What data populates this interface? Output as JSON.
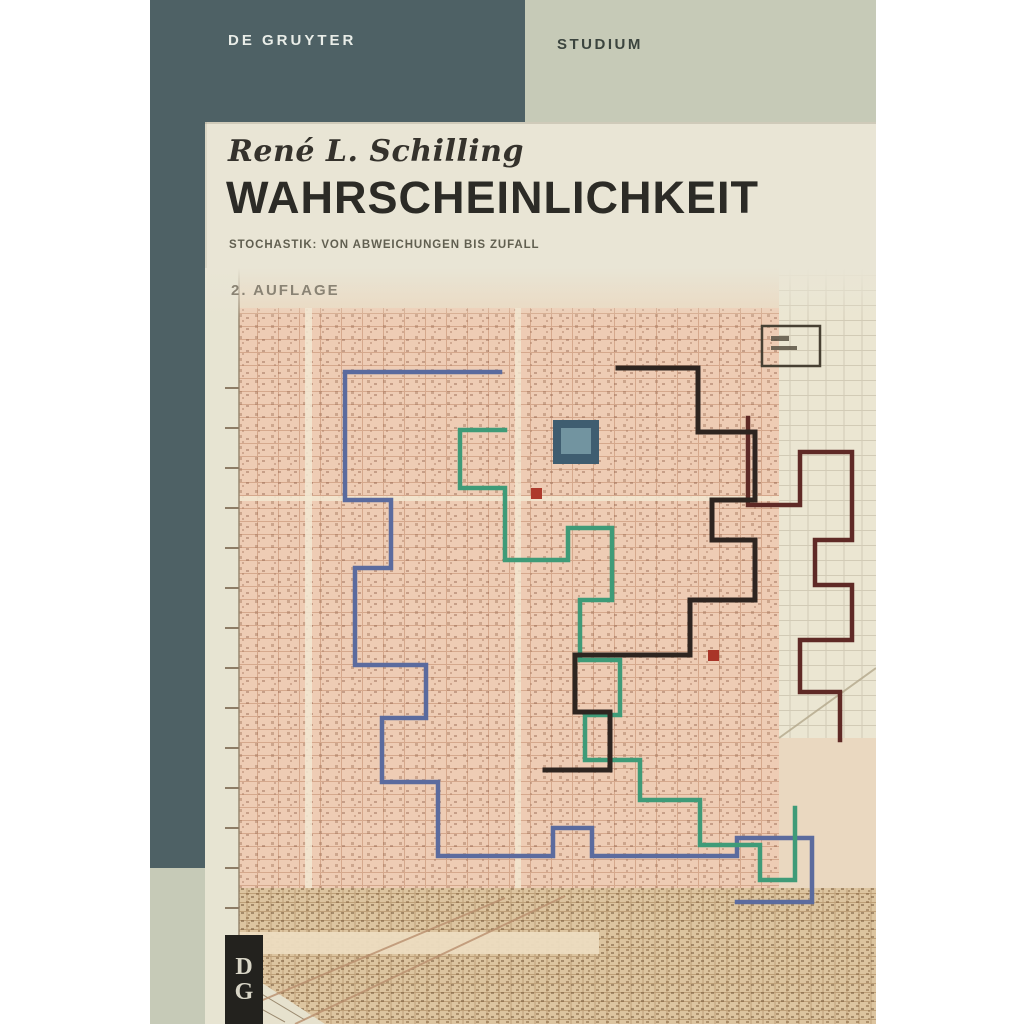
{
  "banner": {
    "publisher": "DE GRUYTER",
    "series": "STUDIUM"
  },
  "cover": {
    "author": "René L. Schilling",
    "title": "WAHRSCHEINLICHKEIT",
    "subtitle": "STOCHASTIK: VON ABWEICHUNGEN BIS ZUFALL",
    "edition": "2. AUFLAGE"
  },
  "logo": {
    "top_letter": "D",
    "bottom_letter": "G"
  },
  "map": {
    "description": "vintage city street-grid map with four lattice random-walk paths",
    "walks": [
      "blue",
      "green",
      "black",
      "maroon"
    ]
  },
  "colors": {
    "banner_dark": "#4e6165",
    "banner_sage": "#c6cab7",
    "cover_bg": "#e9e5d5",
    "title_text": "#2c2b26",
    "subtitle_text": "#615f50",
    "edition_text": "#8a8374",
    "publisher_text": "#e9ede8",
    "series_text": "#3b443e",
    "walk_blue": "#5b6b9e",
    "walk_green": "#3f9b78",
    "walk_black": "#2e2520",
    "walk_maroon": "#5f2a26",
    "map_salmon": "#eeccb4",
    "logo_bg": "#23221e"
  }
}
